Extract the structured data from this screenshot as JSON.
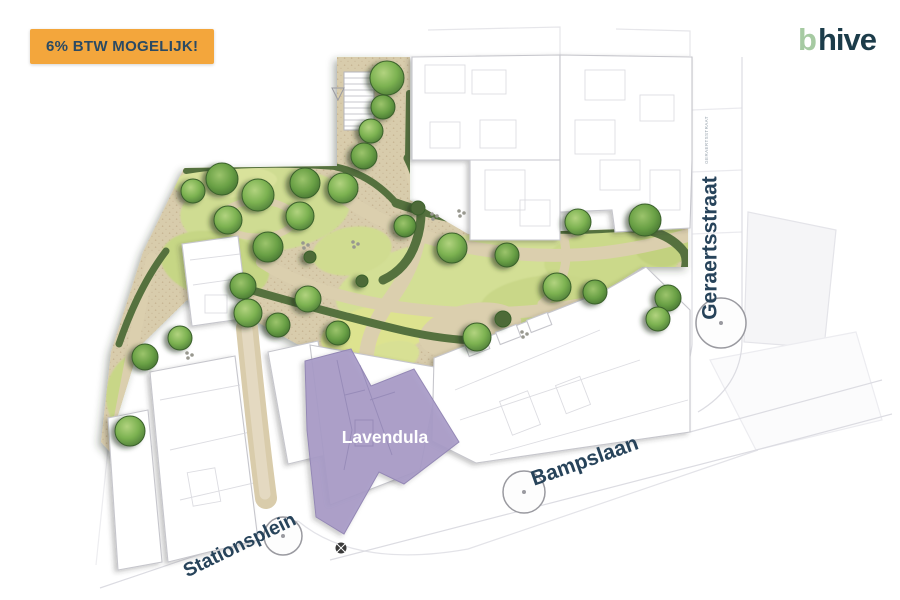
{
  "badge": {
    "label": "6% BTW MOGELIJK!",
    "bg_color": "#F3A63C",
    "text_color": "#2B4A63"
  },
  "logo": {
    "mark": "b",
    "name": "hive",
    "mark_color": "#A6CAA2",
    "name_color": "#1C3C4A"
  },
  "plan": {
    "unit": {
      "label": "Lavendula",
      "fill_color": "#A89BC7",
      "label_color": "#FFFFFF"
    },
    "streets": {
      "geraertsstraat": "Geraertsstraat",
      "bampslaan": "Bampslaan",
      "stationsplein": "Stationsplein",
      "micro_label": "GERAERTSSTRAAT"
    },
    "palette": {
      "lawn": "#CFDC92",
      "lawn_bright": "#DDE38F",
      "path": "#D8CCAC",
      "hedge": "#55713E",
      "tree": "#7CB251",
      "building_fill": "#FFFFFF",
      "building_outline": "#C6C6CC",
      "street_label": "#27435A"
    }
  }
}
